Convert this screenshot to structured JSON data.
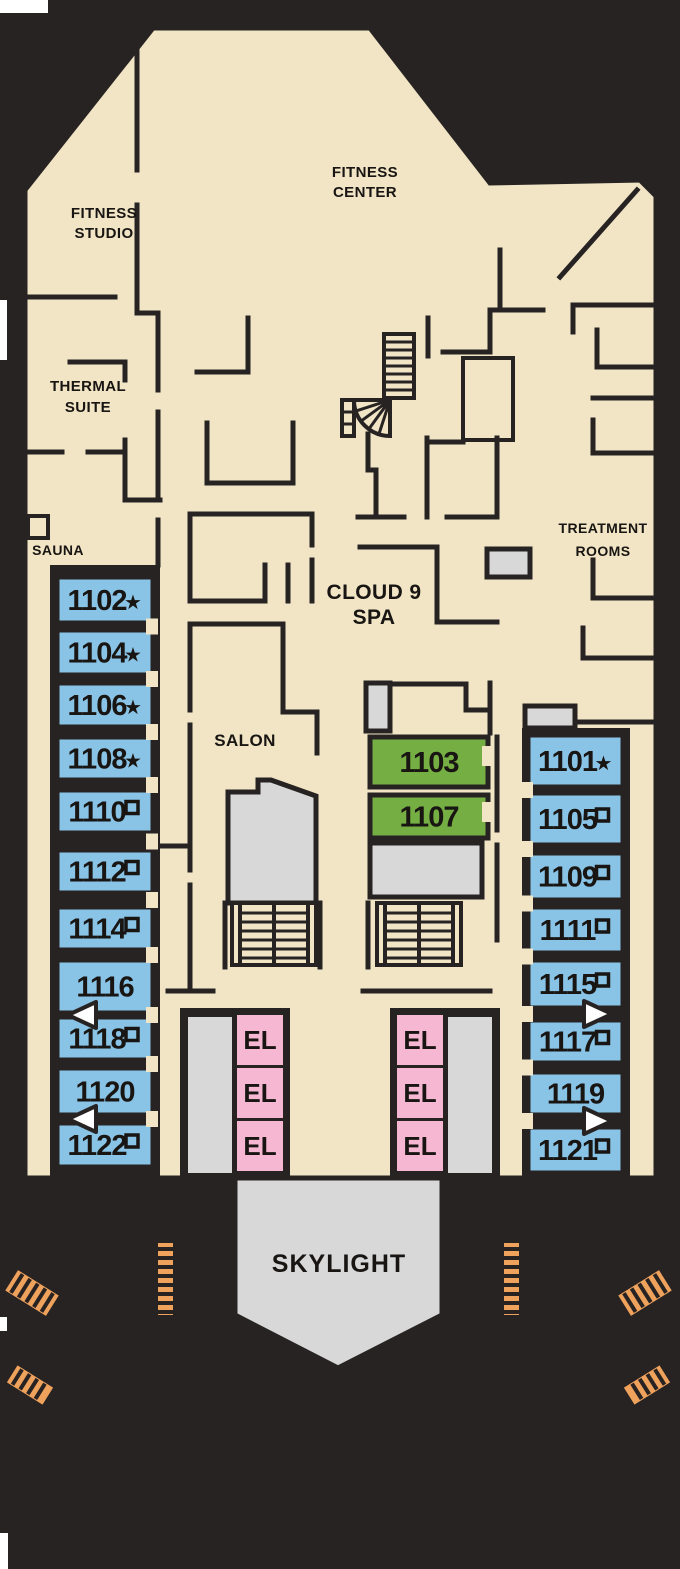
{
  "rooms": {
    "fitness_studio": [
      "FITNESS",
      "STUDIO"
    ],
    "fitness_center": [
      "FITNESS",
      "CENTER"
    ],
    "thermal_suite": [
      "THERMAL",
      "SUITE"
    ],
    "sauna": "SAUNA",
    "cloud9_spa": [
      "CLOUD 9",
      "SPA"
    ],
    "treatment_rooms": [
      "TREATMENT",
      "ROOMS"
    ],
    "salon": "SALON",
    "skylight": "SKYLIGHT"
  },
  "elevators": {
    "label": "EL",
    "count": 6
  },
  "cabins": {
    "left_column": [
      {
        "number": "1102",
        "symbol": "star"
      },
      {
        "number": "1104",
        "symbol": "star"
      },
      {
        "number": "1106",
        "symbol": "star"
      },
      {
        "number": "1108",
        "symbol": "star"
      },
      {
        "number": "1110",
        "symbol": "square"
      },
      {
        "number": "1112",
        "symbol": "square"
      },
      {
        "number": "1114",
        "symbol": "square"
      },
      {
        "number": "1116",
        "symbol": null
      },
      {
        "number": "1118",
        "symbol": "square"
      },
      {
        "number": "1120",
        "symbol": null
      },
      {
        "number": "1122",
        "symbol": "square"
      }
    ],
    "center_column": [
      {
        "number": "1103",
        "symbol": null
      },
      {
        "number": "1107",
        "symbol": null
      }
    ],
    "right_column": [
      {
        "number": "1101",
        "symbol": "star"
      },
      {
        "number": "1105",
        "symbol": "square"
      },
      {
        "number": "1109",
        "symbol": "square"
      },
      {
        "number": "1111",
        "symbol": "square"
      },
      {
        "number": "1115",
        "symbol": "square"
      },
      {
        "number": "1117",
        "symbol": "square"
      },
      {
        "number": "1119",
        "symbol": null
      },
      {
        "number": "1121",
        "symbol": "square"
      }
    ]
  },
  "symbols": {
    "star_glyph": "★"
  },
  "colors": {
    "bg": "#282323",
    "floor": "#f1e5c6",
    "wall": "#282323",
    "blue": "#89c4e7",
    "green": "#75af43",
    "pink": "#f5b7d1",
    "gray": "#d8d8d8",
    "deck": "#efa25c",
    "plank": "#c3803b",
    "ink": "#181512",
    "white": "#ffffff"
  }
}
